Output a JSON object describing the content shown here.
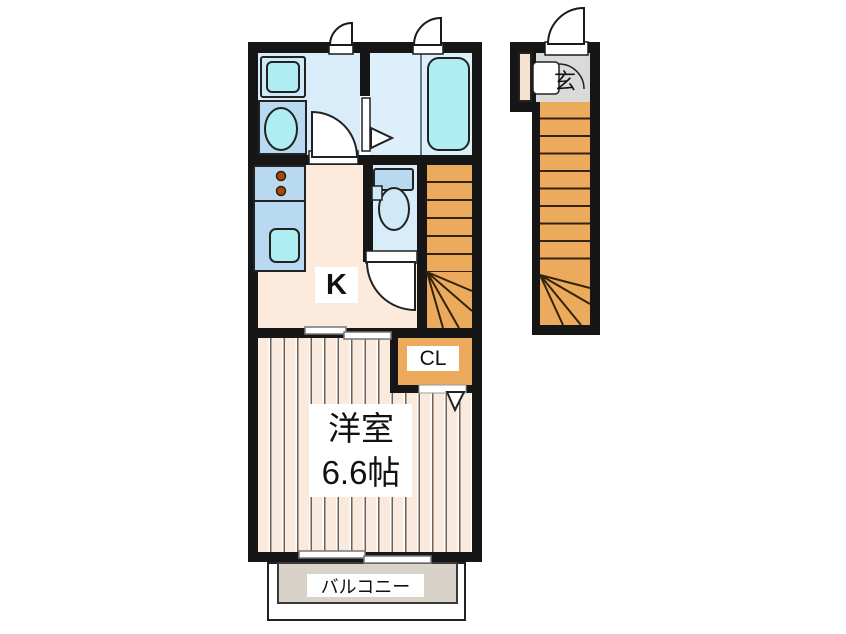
{
  "title": "apartment floor plan",
  "labels": {
    "kitchen": "K",
    "closet": "CL",
    "room_name": "洋室",
    "room_size": "6.6帖",
    "balcony": "バルコニー",
    "entrance": "玄"
  },
  "colors": {
    "wall": "#161616",
    "wet_room_floor": "#d8ecf9",
    "bathroom_floor": "#ddeffb",
    "fixture_blue": "#b9d9f1",
    "fixture_cyan": "#aeeef2",
    "fixture_light": "#cfe9f8",
    "stairs_orange": "#ecaa5c",
    "step_line": "#33230a",
    "kitchen_floor": "#fcebdc",
    "bedroom_floor": "#faeade",
    "bedroom_stripe": "#6b6257",
    "balcony_fill": "#d9d2c9",
    "genkan_gray": "#dadada",
    "shoe_cabinet": "#f5e3d0",
    "burner": "#a34a0e",
    "label_text": "#111111"
  }
}
